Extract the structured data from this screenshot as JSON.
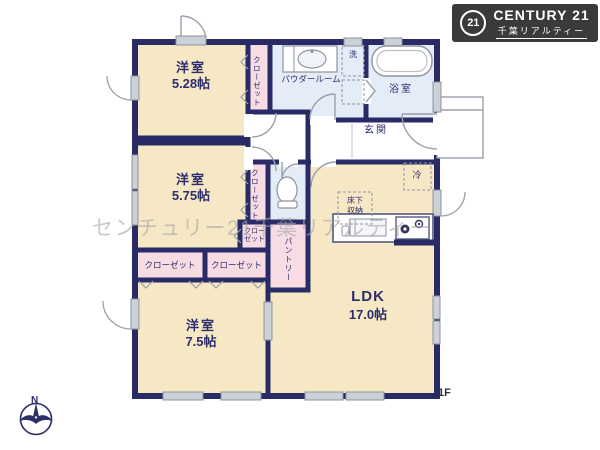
{
  "brand": {
    "logo_badge": "21",
    "logo_name": "CENTURY 21",
    "logo_subtitle": "千葉リアルティー"
  },
  "watermark": "センチュリー21千葉リアルティー",
  "plan": {
    "floor_label": "1F",
    "compass_north": "N",
    "rooms": {
      "bedroom1_name": "洋室",
      "bedroom1_size": "5.28帖",
      "bedroom2_name": "洋室",
      "bedroom2_size": "5.75帖",
      "bedroom3_name": "洋室",
      "bedroom3_size": "7.5帖",
      "ldk_name": "LDK",
      "ldk_size": "17.0帖",
      "powder_room": "パウダールーム",
      "bathroom": "浴室",
      "entrance": "玄関",
      "pantry": "パントリー",
      "closet": "クローゼット",
      "washer": "洗",
      "refrigerator": "冷",
      "underfloor_line1": "床下",
      "underfloor_line2": "収納"
    }
  },
  "colors": {
    "wall": "#282b66",
    "room_fill": "#f7e8c5",
    "closet_fill": "#f8dce4",
    "wet_area_fill": "#e4edf7",
    "logo_bg": "#3a3a3c",
    "watermark": "#a8a8ac"
  }
}
